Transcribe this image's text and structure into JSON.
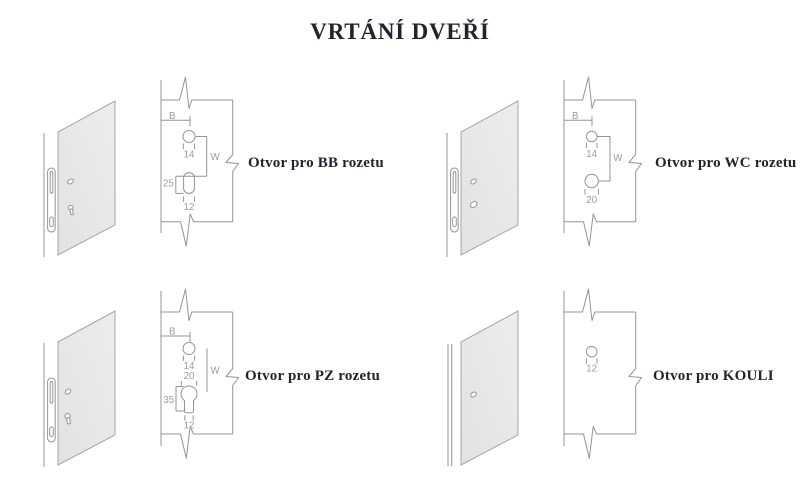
{
  "title": "VRTÁNÍ DVEŘÍ",
  "colors": {
    "line": "#949494",
    "dim_text": "#9c9c9c",
    "label_text": "#23232f",
    "door_fill": "#e7e7e7",
    "background": "#ffffff"
  },
  "diagrams": {
    "bb": {
      "label": "Otvor pro BB rozetu",
      "dims": {
        "b": "B",
        "w": "W",
        "hole": "14",
        "slot_height": "25",
        "slot_width": "12"
      }
    },
    "wc": {
      "label": "Otvor pro WC rozetu",
      "dims": {
        "b": "B",
        "w": "W",
        "hole_top": "14",
        "hole_bottom": "20"
      }
    },
    "pz": {
      "label": "Otvor pro PZ rozetu",
      "dims": {
        "b": "B",
        "w": "W",
        "hole": "14",
        "cylinder_top": "20",
        "cylinder_height": "35",
        "cylinder_width": "12"
      }
    },
    "kouli": {
      "label": "Otvor pro KOULI",
      "dims": {
        "hole": "12"
      }
    }
  }
}
